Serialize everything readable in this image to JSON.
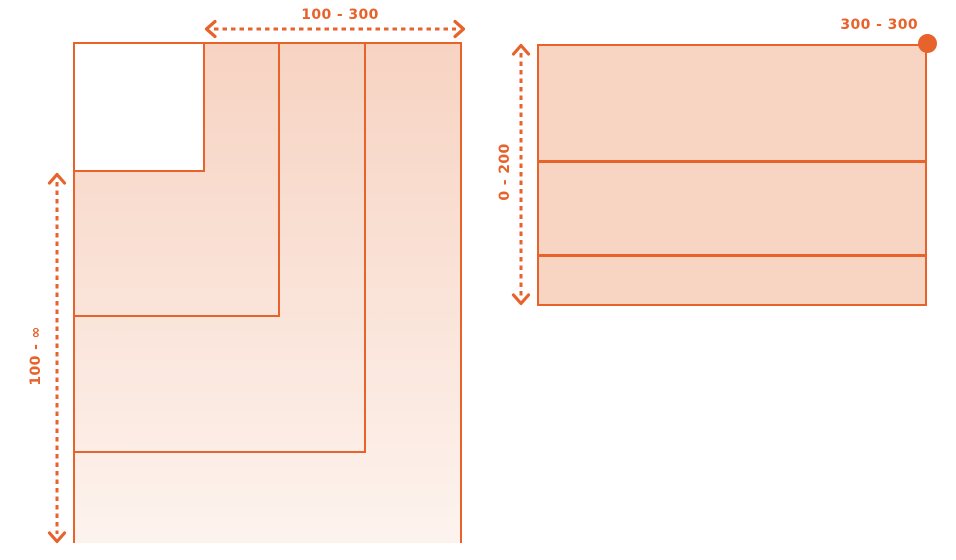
{
  "colors": {
    "accent": "#E8622B",
    "panel_fill": "#F8D5C3",
    "gradient_top": "#F7D3C2",
    "gradient_bottom": "#FDF3EE"
  },
  "left_figure": {
    "description": "nested boxes growing from a white minimum square",
    "width_range": "100 - 300",
    "height_range": "100 - ∞"
  },
  "right_figure": {
    "description": "fixed-width box with three stacked rows and corner handle dot",
    "width_range": "300 - 300",
    "height_range": "0 - 200"
  },
  "icons": {
    "width_range_arrow": "dashed-double-headed-horizontal-arrow",
    "height_range_arrow_left": "dashed-double-headed-vertical-arrow",
    "height_range_arrow_right": "dashed-double-headed-vertical-arrow",
    "corner_dot": "filled-circle-handle"
  }
}
